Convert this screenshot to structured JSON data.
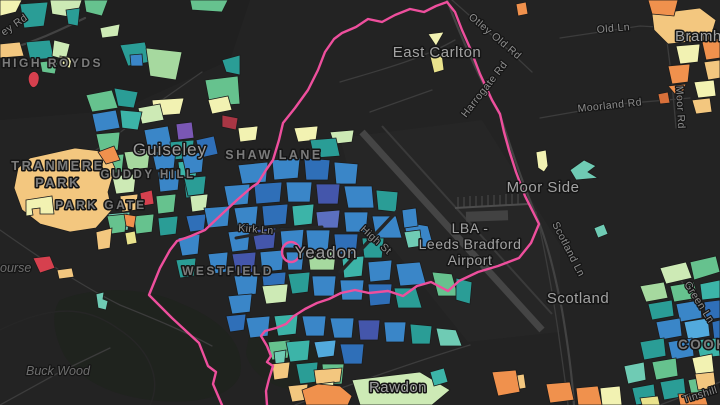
{
  "map": {
    "type": "dark-choropleth-web-map",
    "region": "Yeadon / Guiseley / Leeds Bradford Airport, Leeds UK",
    "boundary_color": "#ee4f9d",
    "background_color": "#232323",
    "palette": {
      "blue": "#3a86c8",
      "dark_blue": "#2f6fb8",
      "indigo": "#4456ab",
      "periwinkle": "#5b6fc0",
      "purple": "#7a57b4",
      "teal": "#2a9d96",
      "bright_teal": "#3cb4a8",
      "cyan_mint": "#6fcbb4",
      "light_blue": "#52aadd",
      "green": "#66c28e",
      "light_green": "#a6d99f",
      "pale_green": "#cdeab5",
      "pale_yellow": "#f2f2b2",
      "yellow": "#e9e28c",
      "sand": "#f3c77f",
      "orange": "#f0914d",
      "dark_orange": "#d8703a",
      "red": "#d6404e",
      "dark_red": "#a93644"
    }
  },
  "labels": {
    "high_royds": "HIGH ROYDS",
    "ey_rd": "ey Rd",
    "east_carlton": "East Carlton",
    "otley_old_rd": "Otley Old Rd",
    "harrogate_rd": "Harrogate Rd",
    "old_ln": "Old Ln",
    "bramhope": "Bramhope",
    "moorland_rd": "Moorland Rd",
    "moor_rd": "Moor Rd",
    "guiseley": "Guiseley",
    "tranmere_line1": "TRANMERE",
    "tranmere_line2": "PARK",
    "guddy_hill": "GUDDY HILL",
    "park_gate": "PARK GATE",
    "shaw_lane": "SHAW LANE",
    "kirk_ln": "Kirk Ln",
    "yeadon": "Yeadon",
    "high_st": "High St",
    "westfield": "WESTFIELD",
    "lba_line1": "LBA -",
    "lba_line2": "Leeds Bradford",
    "lba_line3": "Airport",
    "moor_side": "Moor Side",
    "scotland_ln": "Scotland Ln",
    "scotland": "Scotland",
    "green_ln": "Green Ln",
    "cookridge": "COOKRIDGE",
    "tinshill_ln": "Tinshill Ln",
    "rawdon": "Rawdon",
    "buck_wood": "Buck Wood",
    "course_partial": "ourse"
  }
}
